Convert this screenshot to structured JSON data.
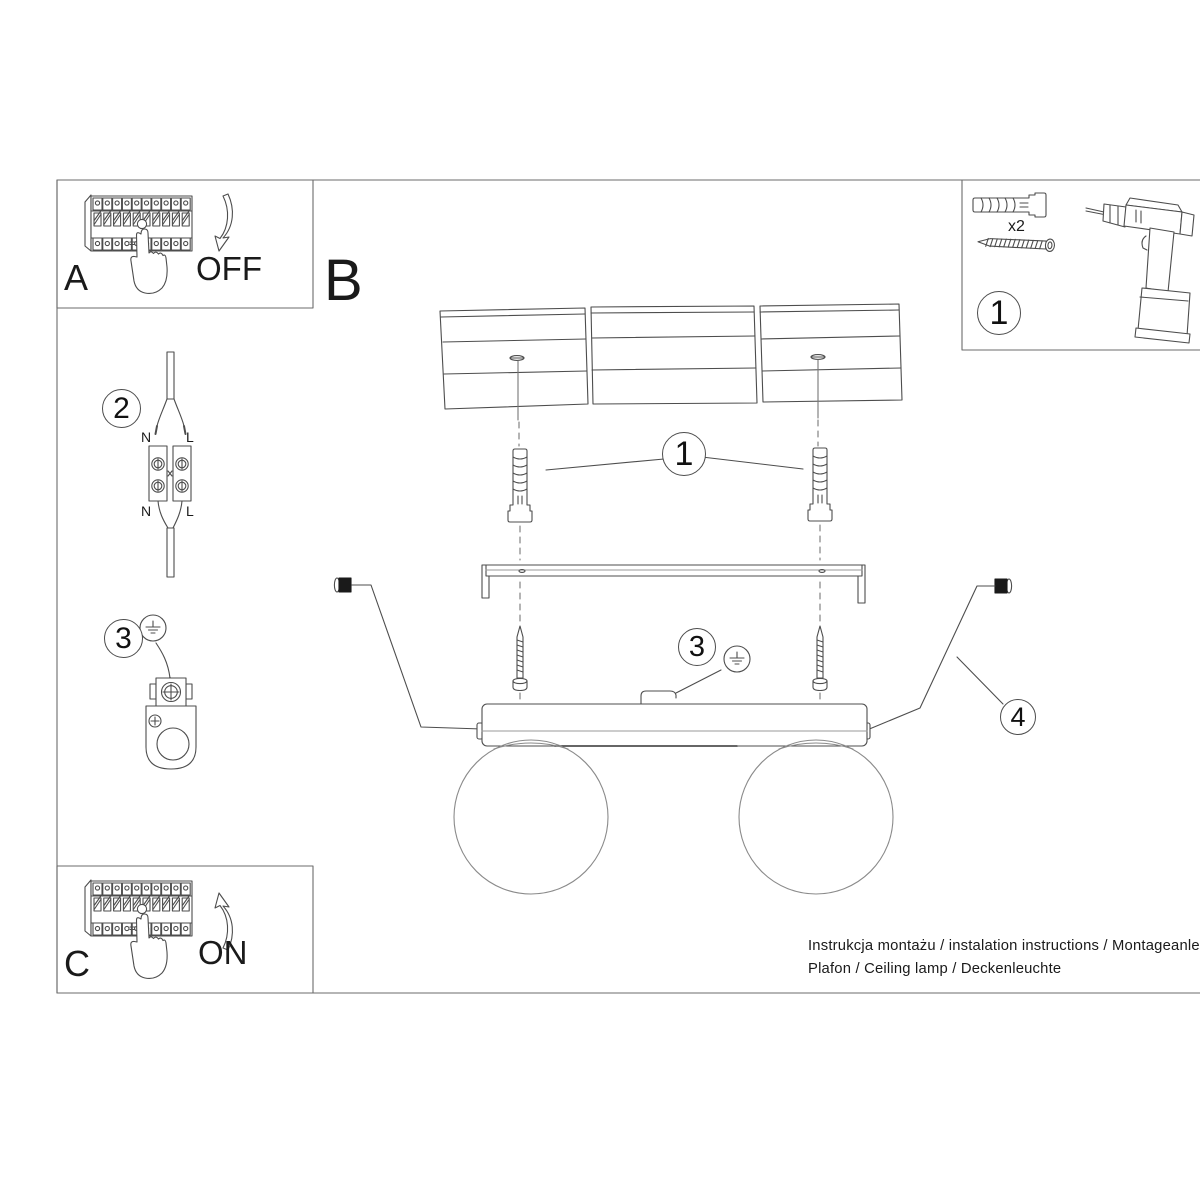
{
  "document": {
    "footer_line1": "Instrukcja montażu / instalation instructions / Montageanleitung",
    "footer_line2": "Plafon / Ceiling lamp / Deckenleuchte"
  },
  "sections": {
    "a": {
      "label": "A",
      "action": "OFF"
    },
    "b": {
      "label": "B"
    },
    "c": {
      "label": "C",
      "action": "ON"
    }
  },
  "parts_box": {
    "callout": "1",
    "screw_quantity": "x2"
  },
  "steps": {
    "wiring": "2",
    "grounding": "3"
  },
  "callouts": {
    "anchor": "1",
    "ground": "3",
    "canopy": "4"
  },
  "wiring_labels": {
    "n_top": "N",
    "l_top": "L",
    "n_bottom": "N",
    "l_bottom": "L"
  },
  "colors": {
    "line": "#4d4d4d",
    "text": "#1a1a1a",
    "background": "#ffffff"
  }
}
